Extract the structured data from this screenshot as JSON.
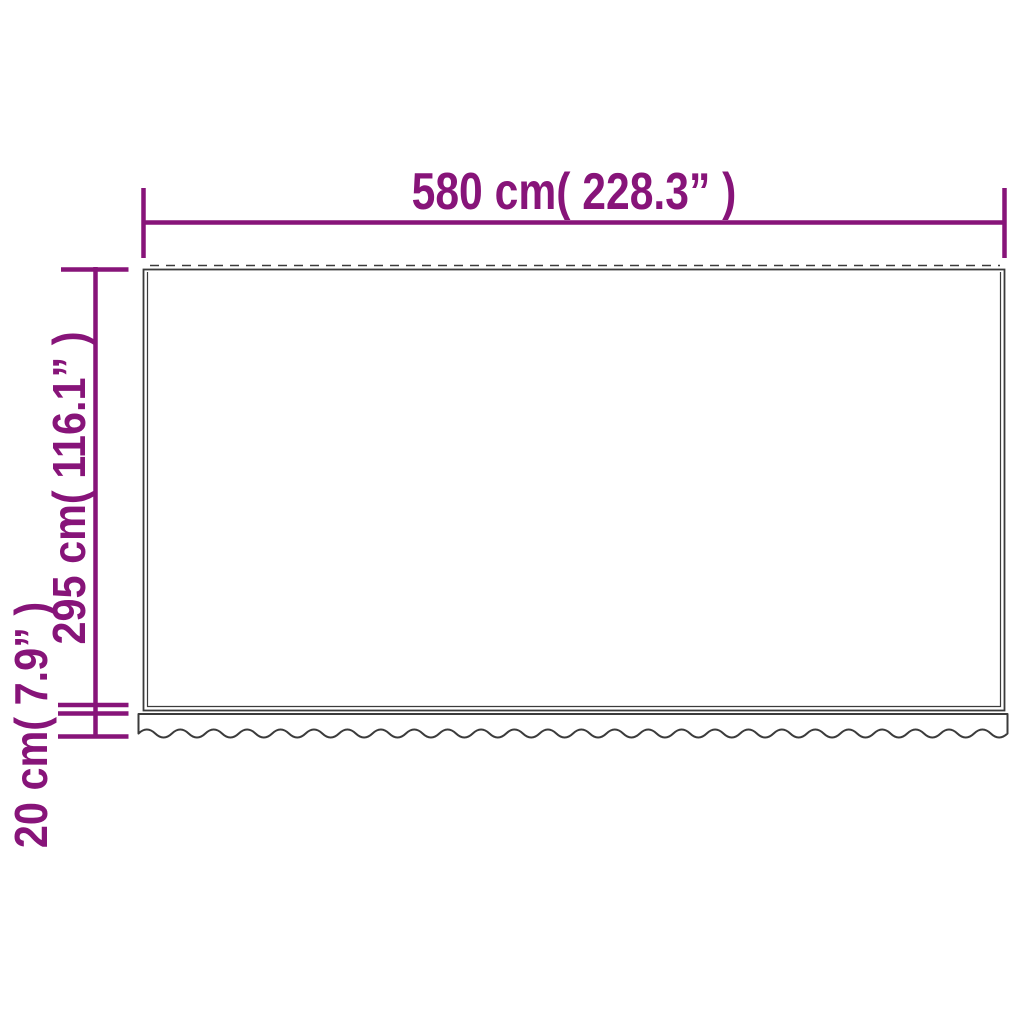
{
  "diagram": {
    "dimensions": {
      "width": {
        "label": "580 cm( 228.3” )",
        "cm": 580,
        "inches": 228.3
      },
      "height": {
        "label": "295 cm( 116.1” )",
        "cm": 295,
        "inches": 116.1
      },
      "valance": {
        "label": "20 cm( 7.9” )",
        "cm": 20,
        "inches": 7.9
      }
    },
    "colors": {
      "dimension_accent": "#871479",
      "fabric_outline": "#3b3b3b",
      "background": "#ffffff"
    }
  }
}
